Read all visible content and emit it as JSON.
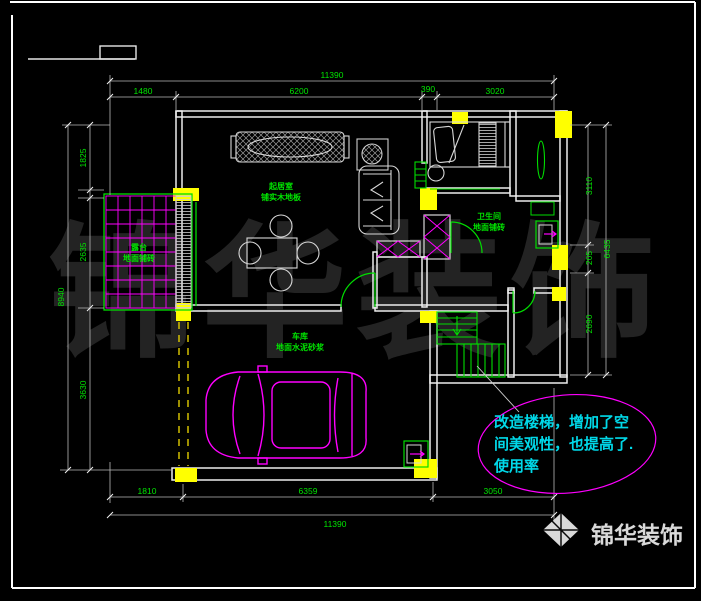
{
  "watermark": "锦华装饰",
  "logo": {
    "name": "锦华装饰"
  },
  "annotation": {
    "line1": "改造楼梯，增加了空",
    "line2": "间美观性，也提高了.",
    "line3": "使用率"
  },
  "rooms": {
    "living": {
      "name": "起居室",
      "finish": "铺实木地板"
    },
    "terrace": {
      "name": "露台",
      "finish": "地面铺砖"
    },
    "garage": {
      "name": "车库",
      "finish": "地面水泥砂浆"
    },
    "bath": {
      "name": "卫生间",
      "finish": "地面铺砖"
    }
  },
  "dims": {
    "top_total": "11390",
    "top": [
      "1480",
      "6200",
      "390",
      "3020"
    ],
    "bottom": [
      "1810",
      "6359",
      "3050"
    ],
    "bottom_total": "11390",
    "left": [
      "1825",
      "2635",
      "3630"
    ],
    "left_total": "8940",
    "right": [
      "3110",
      "205",
      "2690"
    ],
    "right_total": "6435"
  },
  "colors": {
    "background": "#000000",
    "wall_line": "#ededed",
    "dim_text": "#00e400",
    "new_work_green": "#00dd00",
    "furniture_magenta": "#ff00ff",
    "column_yellow": "#ffff00",
    "annotation_cyan": "#00d8e8",
    "watermark_gray": "#232323"
  }
}
